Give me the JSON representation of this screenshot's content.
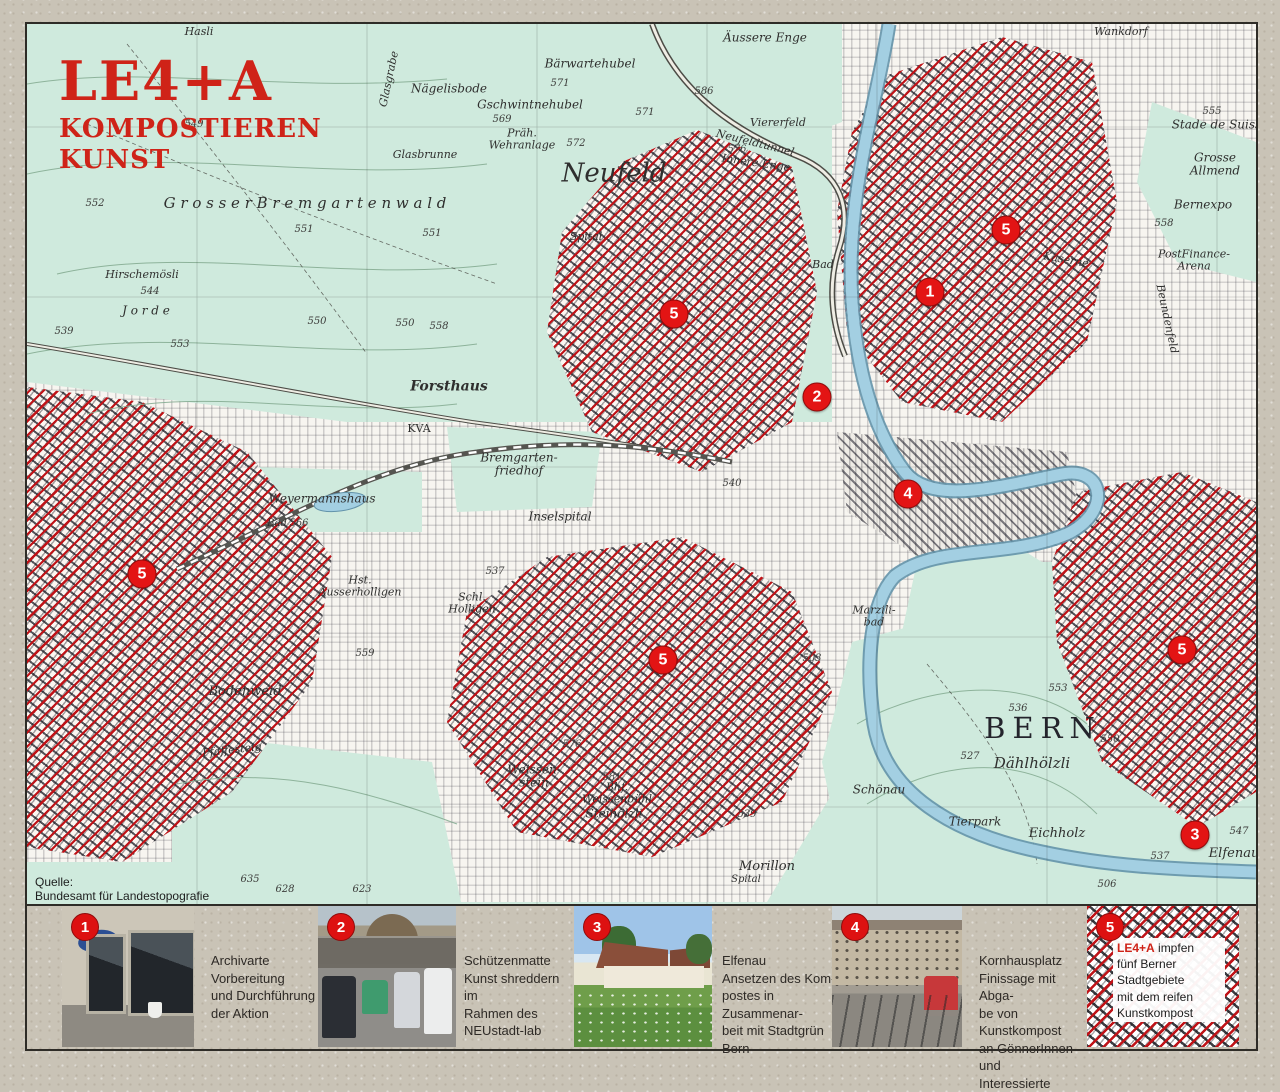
{
  "title": {
    "line1": "LE4+A",
    "line2": "KOMPOSTIEREN",
    "line3": "KUNST"
  },
  "source_note": "Quelle:\nBundesamt für Landestopografie",
  "colors": {
    "hatch_red": "#c01318",
    "marker_red": "#e31414",
    "title_red": "#cf2318",
    "map_green": "#cfeadd",
    "river_blue": "#a3cfe2",
    "paper": "#c9c3b6"
  },
  "map": {
    "markers": [
      {
        "n": "1",
        "x": 903,
        "y": 268
      },
      {
        "n": "2",
        "x": 790,
        "y": 373
      },
      {
        "n": "4",
        "x": 881,
        "y": 470
      },
      {
        "n": "3",
        "x": 1168,
        "y": 811
      },
      {
        "n": "5",
        "x": 979,
        "y": 206
      },
      {
        "n": "5",
        "x": 647,
        "y": 290
      },
      {
        "n": "5",
        "x": 115,
        "y": 550
      },
      {
        "n": "5",
        "x": 636,
        "y": 636
      },
      {
        "n": "5",
        "x": 1155,
        "y": 626
      }
    ],
    "labels": [
      {
        "t": "Hasli",
        "x": 172,
        "y": 8,
        "c": "it s11"
      },
      {
        "t": "Glasgrabe",
        "x": 362,
        "y": 55,
        "c": "it s11",
        "r": -78
      },
      {
        "t": "Nägelisbode",
        "x": 422,
        "y": 65,
        "c": "it s12"
      },
      {
        "t": "549",
        "x": 167,
        "y": 101,
        "c": "num"
      },
      {
        "t": "Bärwartehubel",
        "x": 563,
        "y": 40,
        "c": "it s12"
      },
      {
        "t": "571",
        "x": 533,
        "y": 60,
        "c": "num"
      },
      {
        "t": "Gschwintnehubel",
        "x": 503,
        "y": 81,
        "c": "it s12"
      },
      {
        "t": "569",
        "x": 475,
        "y": 96,
        "c": "num"
      },
      {
        "t": "Präh.\nWehranlage",
        "x": 495,
        "y": 115,
        "c": "it s11 pre"
      },
      {
        "t": "572",
        "x": 549,
        "y": 120,
        "c": "num"
      },
      {
        "t": "Glasbrunne",
        "x": 398,
        "y": 131,
        "c": "it s11"
      },
      {
        "t": "G r o s s e r   B r e m g a r t e n w a l d",
        "x": 278,
        "y": 180,
        "c": "it s15"
      },
      {
        "t": "552",
        "x": 68,
        "y": 180,
        "c": "num"
      },
      {
        "t": "551",
        "x": 277,
        "y": 206,
        "c": "num"
      },
      {
        "t": "551",
        "x": 405,
        "y": 210,
        "c": "num"
      },
      {
        "t": "550",
        "x": 290,
        "y": 298,
        "c": "num"
      },
      {
        "t": "550",
        "x": 378,
        "y": 300,
        "c": "num"
      },
      {
        "t": "Hirschemösli",
        "x": 115,
        "y": 251,
        "c": "it s11"
      },
      {
        "t": "544",
        "x": 123,
        "y": 268,
        "c": "num"
      },
      {
        "t": "J o r d e",
        "x": 119,
        "y": 287,
        "c": "it s12"
      },
      {
        "t": "553",
        "x": 153,
        "y": 321,
        "c": "num"
      },
      {
        "t": "558",
        "x": 412,
        "y": 303,
        "c": "num"
      },
      {
        "t": "539",
        "x": 37,
        "y": 308,
        "c": "num"
      },
      {
        "t": "Neufeld",
        "x": 587,
        "y": 150,
        "c": "it s26"
      },
      {
        "t": "Neufeldtunnel",
        "x": 728,
        "y": 119,
        "c": "it s11",
        "r": 14
      },
      {
        "t": "Innere Enge",
        "x": 729,
        "y": 139,
        "c": "it s11",
        "r": 8
      },
      {
        "t": "576",
        "x": 710,
        "y": 126,
        "c": "num"
      },
      {
        "t": "Viererfeld",
        "x": 751,
        "y": 99,
        "c": "it s11"
      },
      {
        "t": "Äussere Enge",
        "x": 738,
        "y": 14,
        "c": "it s12"
      },
      {
        "t": "Spital",
        "x": 559,
        "y": 213,
        "c": "it s11"
      },
      {
        "t": "Bad",
        "x": 796,
        "y": 241,
        "c": "it s11"
      },
      {
        "t": "Wankdorf",
        "x": 1094,
        "y": 8,
        "c": "it s11"
      },
      {
        "t": "Stade de Suisse",
        "x": 1193,
        "y": 101,
        "c": "it s12"
      },
      {
        "t": "Grosse\nAllmend",
        "x": 1188,
        "y": 140,
        "c": "it s12 pre"
      },
      {
        "t": "Bernexpo",
        "x": 1176,
        "y": 181,
        "c": "it s12"
      },
      {
        "t": "PostFinance-\nArena",
        "x": 1167,
        "y": 236,
        "c": "it s11 pre"
      },
      {
        "t": "555",
        "x": 1185,
        "y": 88,
        "c": "num"
      },
      {
        "t": "558",
        "x": 1137,
        "y": 200,
        "c": "num"
      },
      {
        "t": "Kaserne",
        "x": 1039,
        "y": 236,
        "c": "it s11",
        "r": 10
      },
      {
        "t": "Beundenfeld",
        "x": 1140,
        "y": 295,
        "c": "it s11",
        "r": 78
      },
      {
        "t": "BERN",
        "x": 1016,
        "y": 704,
        "c": "sp s30"
      },
      {
        "t": "Dählhölzli",
        "x": 1005,
        "y": 740,
        "c": "it s15"
      },
      {
        "t": "536",
        "x": 991,
        "y": 685,
        "c": "num"
      },
      {
        "t": "527",
        "x": 943,
        "y": 733,
        "c": "num"
      },
      {
        "t": "550",
        "x": 1083,
        "y": 716,
        "c": "num"
      },
      {
        "t": "553",
        "x": 1031,
        "y": 665,
        "c": "num"
      },
      {
        "t": "Tierpark",
        "x": 948,
        "y": 798,
        "c": "it s12"
      },
      {
        "t": "Eichholz",
        "x": 1030,
        "y": 810,
        "c": "it s13"
      },
      {
        "t": "Elfenau",
        "x": 1207,
        "y": 830,
        "c": "it s13"
      },
      {
        "t": "547",
        "x": 1212,
        "y": 808,
        "c": "num"
      },
      {
        "t": "537",
        "x": 1133,
        "y": 833,
        "c": "num"
      },
      {
        "t": "506",
        "x": 1080,
        "y": 861,
        "c": "num"
      },
      {
        "t": "Morillon",
        "x": 740,
        "y": 843,
        "c": "it s13"
      },
      {
        "t": "Spital",
        "x": 719,
        "y": 856,
        "c": "it s10"
      },
      {
        "t": "539",
        "x": 720,
        "y": 791,
        "c": "num"
      },
      {
        "t": "Weissen-\nstein",
        "x": 507,
        "y": 752,
        "c": "it s12 pre"
      },
      {
        "t": "Bhf.\nWeissenbühl",
        "x": 590,
        "y": 769,
        "c": "it s11 pre"
      },
      {
        "t": "Steihölzli",
        "x": 587,
        "y": 790,
        "c": "it s12"
      },
      {
        "t": "581",
        "x": 585,
        "y": 754,
        "c": "num"
      },
      {
        "t": "576",
        "x": 545,
        "y": 721,
        "c": "num"
      },
      {
        "t": "Schönau",
        "x": 852,
        "y": 766,
        "c": "it s12"
      },
      {
        "t": "Marzili-\nbad",
        "x": 847,
        "y": 592,
        "c": "it s11 pre"
      },
      {
        "t": "503",
        "x": 785,
        "y": 635,
        "c": "num"
      },
      {
        "t": "Forsthaus",
        "x": 422,
        "y": 363,
        "c": "it s14"
      },
      {
        "t": "KVA",
        "x": 392,
        "y": 405,
        "c": "s11"
      },
      {
        "t": "Bremgarten-\nfriedhof",
        "x": 492,
        "y": 440,
        "c": "it s12 pre"
      },
      {
        "t": "Inselspital",
        "x": 533,
        "y": 493,
        "c": "it s12"
      },
      {
        "t": "Weyermannshaus",
        "x": 295,
        "y": 475,
        "c": "it s12"
      },
      {
        "t": "Bad",
        "x": 250,
        "y": 500,
        "c": "it s10"
      },
      {
        "t": "566",
        "x": 272,
        "y": 500,
        "c": "num"
      },
      {
        "t": "Hst.\nAusserholligen",
        "x": 333,
        "y": 562,
        "c": "it s11 pre"
      },
      {
        "t": "Schl.\nHolligen",
        "x": 445,
        "y": 579,
        "c": "it s11 pre"
      },
      {
        "t": "537",
        "x": 468,
        "y": 548,
        "c": "num"
      },
      {
        "t": "559",
        "x": 338,
        "y": 630,
        "c": "num"
      },
      {
        "t": "Bodenweid",
        "x": 218,
        "y": 668,
        "c": "it s13"
      },
      {
        "t": "Pfaffesteig",
        "x": 205,
        "y": 726,
        "c": "it s11",
        "r": -6
      },
      {
        "t": "635",
        "x": 223,
        "y": 856,
        "c": "num"
      },
      {
        "t": "628",
        "x": 258,
        "y": 866,
        "c": "num"
      },
      {
        "t": "623",
        "x": 335,
        "y": 866,
        "c": "num"
      },
      {
        "t": "540",
        "x": 705,
        "y": 460,
        "c": "num"
      },
      {
        "t": "586",
        "x": 677,
        "y": 68,
        "c": "num"
      },
      {
        "t": "571",
        "x": 618,
        "y": 89,
        "c": "num"
      }
    ]
  },
  "legend": {
    "items": [
      {
        "number": "1",
        "caption": "Archivarte\nVorbereitung\nund  Durchführung\nder Aktion"
      },
      {
        "number": "2",
        "caption": "Schützenmatte\nKunst shreddern im\nRahmen des NEUstadt-lab"
      },
      {
        "number": "3",
        "caption": "Elfenau\nAnsetzen des Kom-\npostes in Zusammenar-\nbeit mit Stadtgrün Bern"
      },
      {
        "number": "4",
        "caption": "Kornhausplatz\nFinissage mit Abga-\nbe von Kunstkompost\nan GönnerInnen und\nInteressierte"
      },
      {
        "number": "5",
        "brand": "LE4+A",
        "caption": " impfen\nfünf Berner\nStadtgebiete\nmit dem reifen\nKunstkompost"
      }
    ]
  }
}
